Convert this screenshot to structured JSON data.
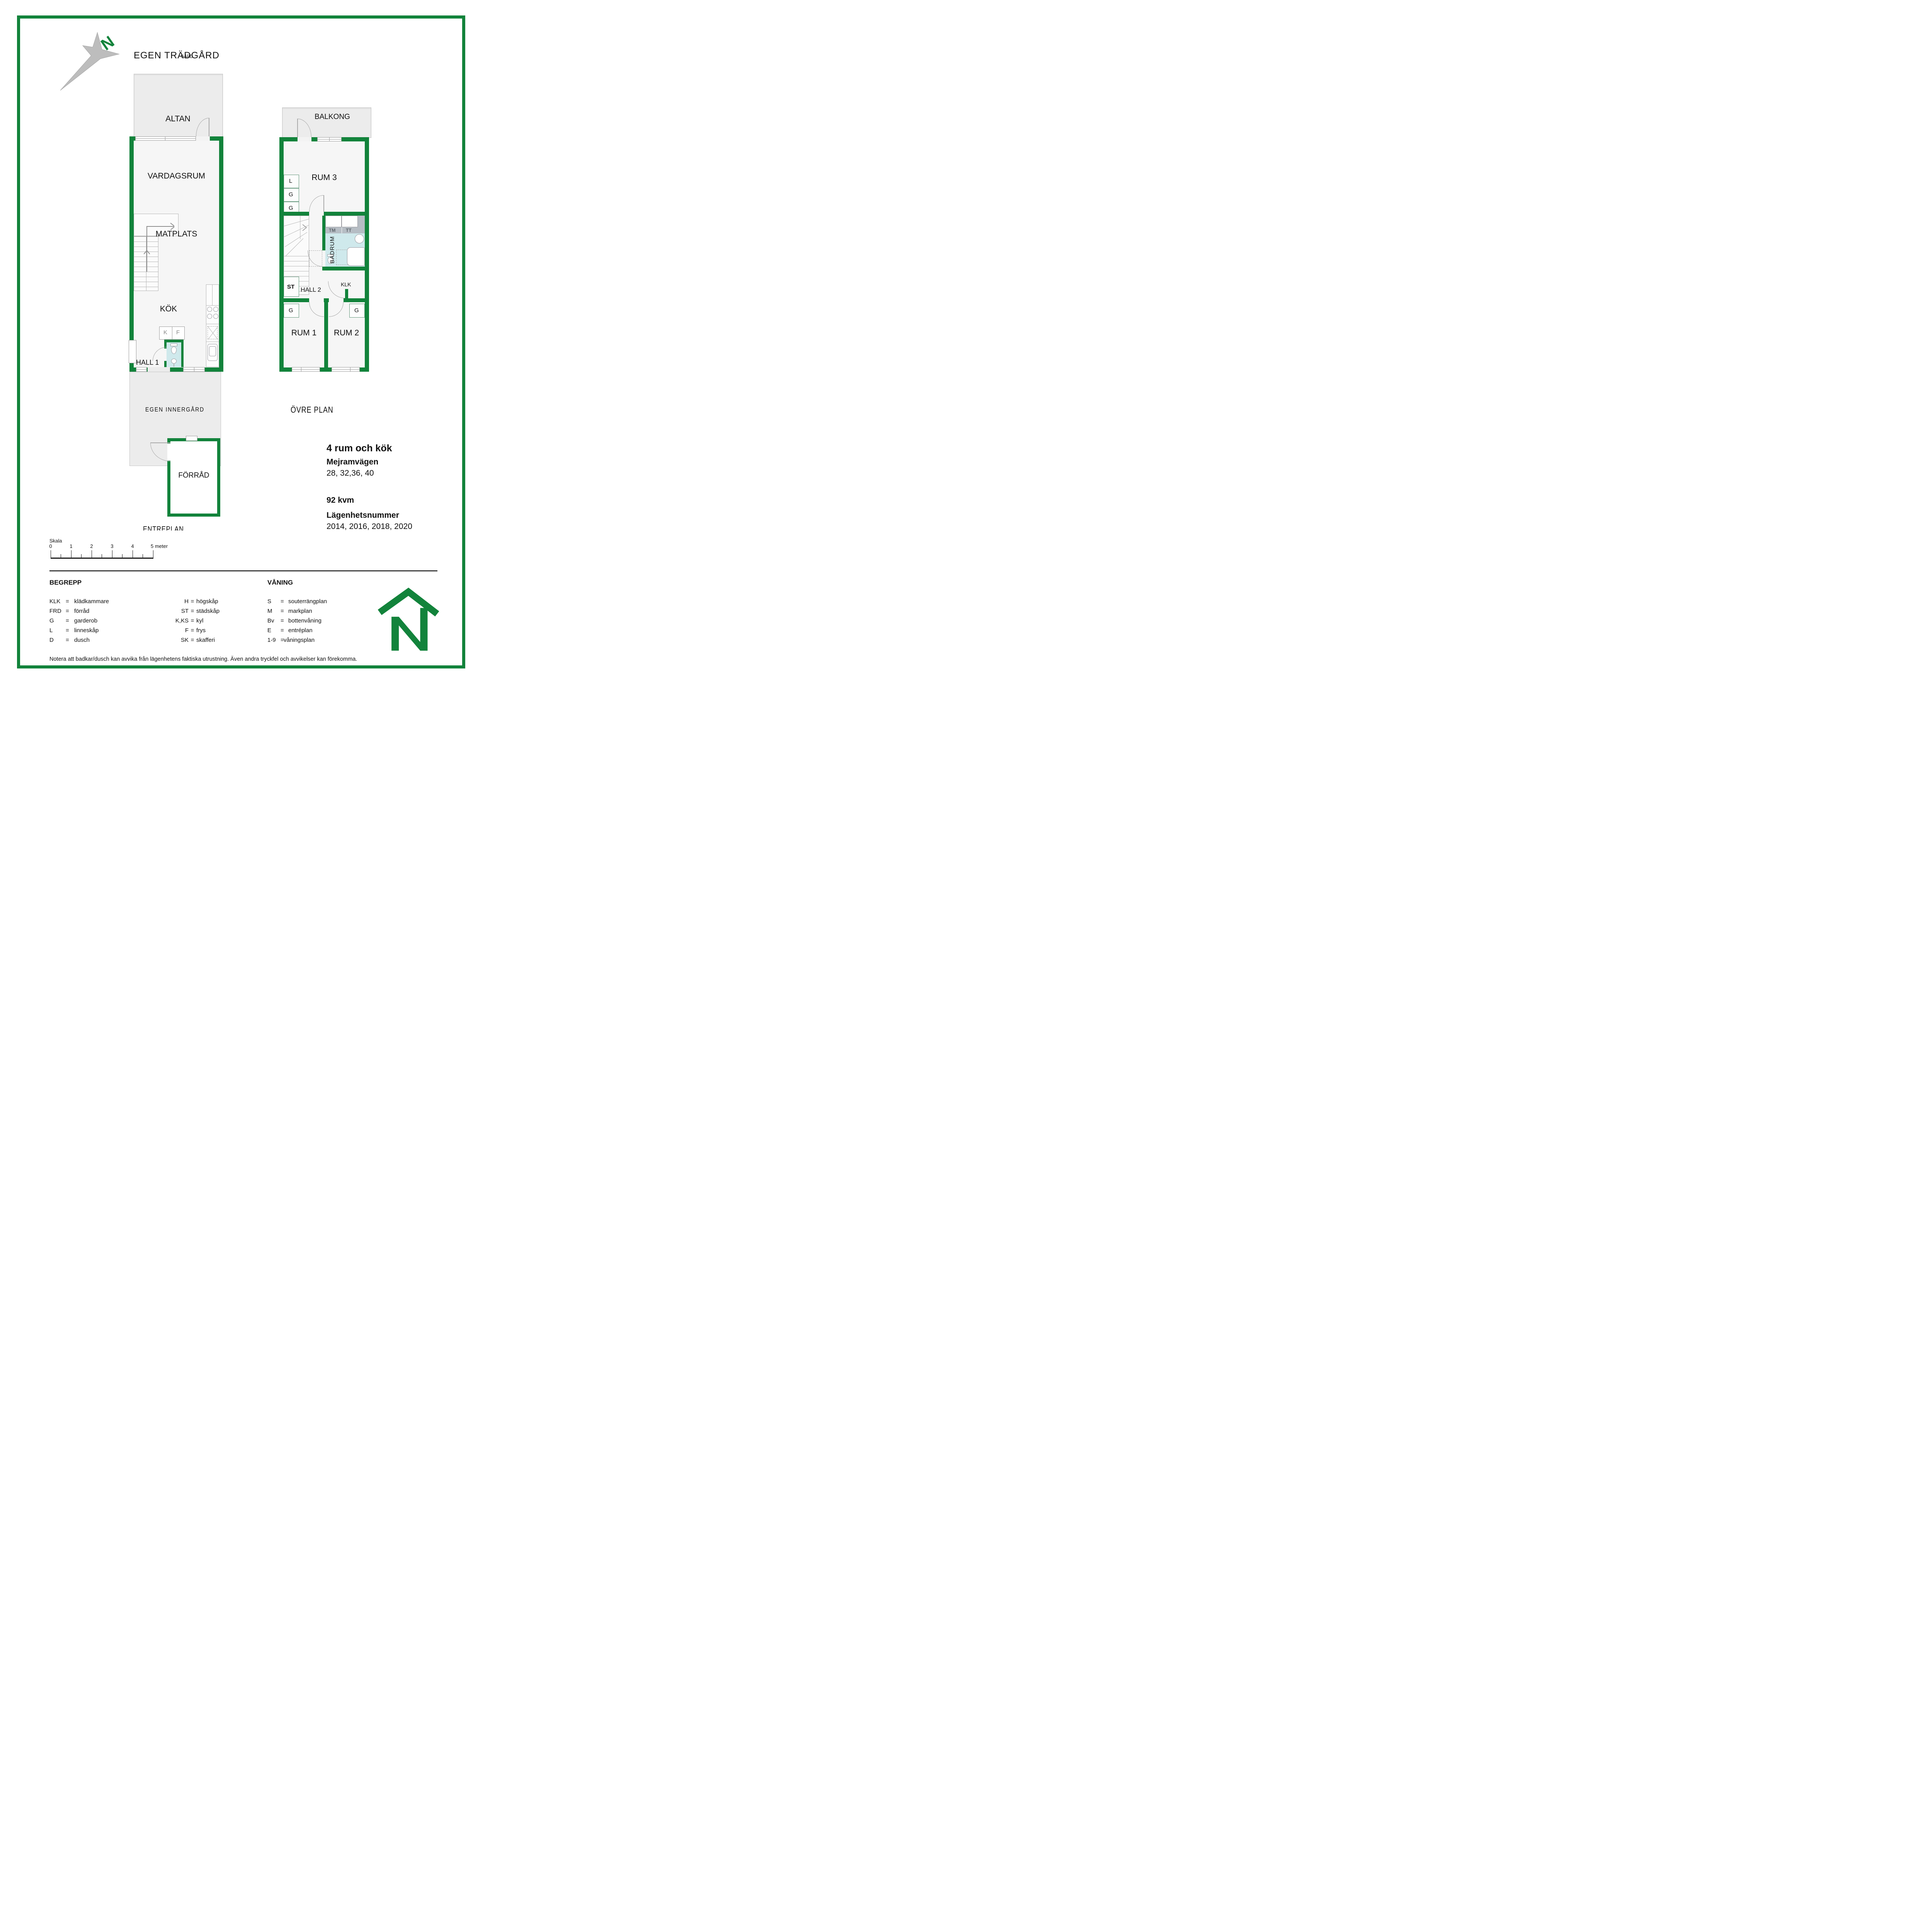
{
  "compass": {
    "n": "N"
  },
  "header": {
    "garden_label": "EGEN TRÄDGÅRD",
    "artifact_label": "GÅRD"
  },
  "floor1": {
    "altan": "ALTAN",
    "vardagsrum": "VARDAGSRUM",
    "matplats": "MATPLATS",
    "kok": "KÖK",
    "k": "K",
    "f": "F",
    "hall1": "HALL 1",
    "innergard": "EGEN INNERGÅRD",
    "forrad": "FÖRRÅD",
    "plan_label": "ENTREPLAN"
  },
  "floor2": {
    "balkong": "BALKONG",
    "rum3": "RUM 3",
    "closets": [
      "L",
      "G",
      "G"
    ],
    "tm": "TM",
    "tt": "TT",
    "badrum": "BADRUM",
    "st": "ST",
    "hall2": "HALL 2",
    "klk": "KLK",
    "g_rum1": "G",
    "g_rum2": "G",
    "rum1": "RUM 1",
    "rum2": "RUM 2",
    "plan_label": "ÖVRE PLAN"
  },
  "info": {
    "title": "4 rum och kök",
    "street": "Mejramvägen",
    "street_numbers": "28, 32,36, 40",
    "area": "92 kvm",
    "apartment_label": "Lägenhetsnummer",
    "apartment_numbers": "2014, 2016, 2018, 2020"
  },
  "scale": {
    "label": "Skala",
    "ticks": [
      "0",
      "1",
      "2",
      "3",
      "4"
    ],
    "end_label": "5 meter"
  },
  "legend": {
    "title": "BEGREPP",
    "col1": [
      {
        "abbr": "KLK",
        "eq": "=",
        "term": "klädkammare"
      },
      {
        "abbr": "FRD",
        "eq": "=",
        "term": "förråd"
      },
      {
        "abbr": "G",
        "eq": "=",
        "term": "garderob"
      },
      {
        "abbr": "L",
        "eq": "=",
        "term": "linneskåp"
      },
      {
        "abbr": "D",
        "eq": "=",
        "term": "dusch"
      }
    ],
    "col2": [
      {
        "abbr": "H",
        "eq": "=",
        "term": "högskåp"
      },
      {
        "abbr": "ST",
        "eq": "=",
        "term": "städskåp"
      },
      {
        "abbr": "K,KS",
        "eq": "=",
        "term": "kyl"
      },
      {
        "abbr": "F",
        "eq": "=",
        "term": "frys"
      },
      {
        "abbr": "SK",
        "eq": "=",
        "term": "skafferi"
      }
    ]
  },
  "floors_legend": {
    "title": "VÅNING",
    "rows": [
      {
        "abbr": "S",
        "eq": "=",
        "term": "souterrängplan"
      },
      {
        "abbr": "M",
        "eq": "=",
        "term": "markplan"
      },
      {
        "abbr": "Bv",
        "eq": "=",
        "term": "bottenvåning"
      },
      {
        "abbr": "E",
        "eq": "=",
        "term": "entréplan"
      },
      {
        "abbr": "1-9",
        "eq": "=",
        "term": "våningsplan"
      }
    ]
  },
  "footnote": "Notera att badkar/dusch kan avvika från lägenhetens faktiska utrustning. Även andra tryckfel och avvikelser kan förekomma.",
  "colors": {
    "wall_green": "#12833B",
    "bath_blue": "#cfe9ec",
    "deck_gray": "#ececec",
    "appliance_gray": "#b6bdc4"
  }
}
